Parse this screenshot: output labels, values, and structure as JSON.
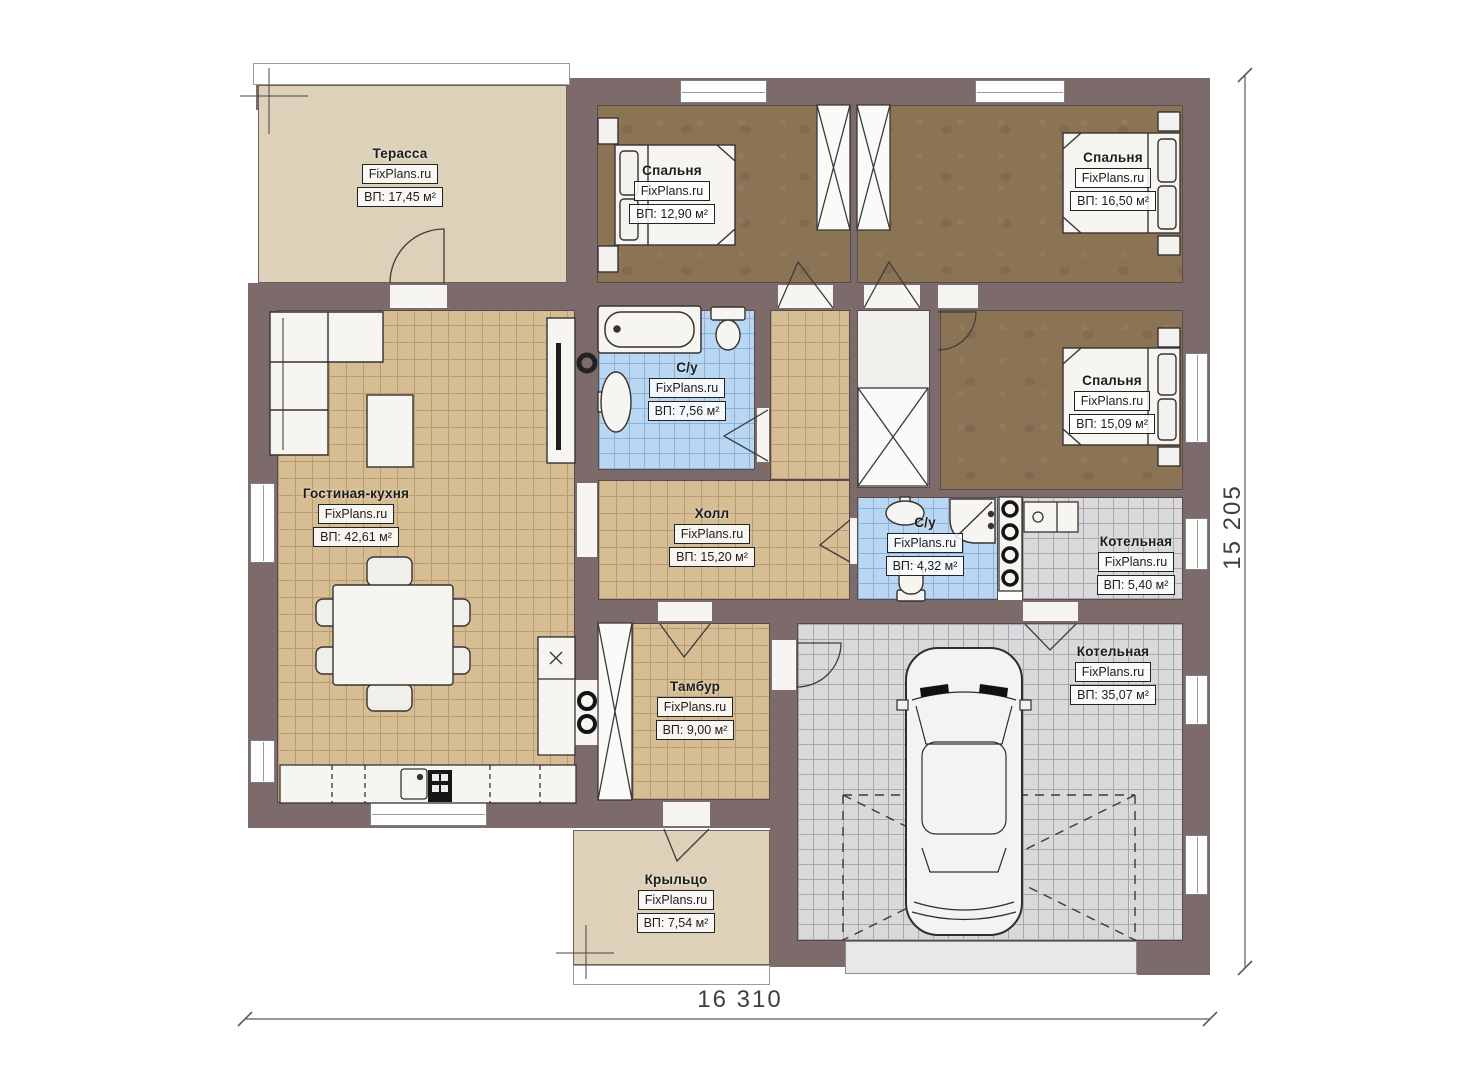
{
  "watermark": "FixPlans.ru",
  "rooms": {
    "terrace": {
      "name": "Терасса",
      "area": "ВП: 17,45 м²"
    },
    "bedroom1": {
      "name": "Спальня",
      "area": "ВП: 12,90 м²"
    },
    "bedroom2": {
      "name": "Спальня",
      "area": "ВП: 16,50 м²"
    },
    "bathroom_main": {
      "name": "С/у",
      "area": "ВП: 7,56 м²"
    },
    "bedroom3": {
      "name": "Спальня",
      "area": "ВП: 15,09 м²"
    },
    "living_kitchen": {
      "name": "Гостиная-кухня",
      "area": "ВП: 42,61 м²"
    },
    "hall": {
      "name": "Холл",
      "area": "ВП: 15,20 м²"
    },
    "bathroom_small": {
      "name": "С/у",
      "area": "ВП: 4,32 м²"
    },
    "boiler": {
      "name": "Котельная",
      "area": "ВП: 5,40 м²"
    },
    "garage": {
      "name": "Котельная",
      "area": "ВП: 35,07 м²"
    },
    "vestibule": {
      "name": "Тамбур",
      "area": "ВП: 9,00 м²"
    },
    "porch": {
      "name": "Крыльцо",
      "area": "ВП: 7,54 м²"
    }
  },
  "dimensions": {
    "width": "16 310",
    "height": "15 205"
  },
  "colors": {
    "wall": "#7d6b6c",
    "tile_tan": "#d6bd93",
    "tile_blue": "#b9d6f2",
    "tile_gray": "#d9d9db",
    "bedroom_floor": "#8b7355",
    "terrace_floor": "#ddd1ba"
  }
}
